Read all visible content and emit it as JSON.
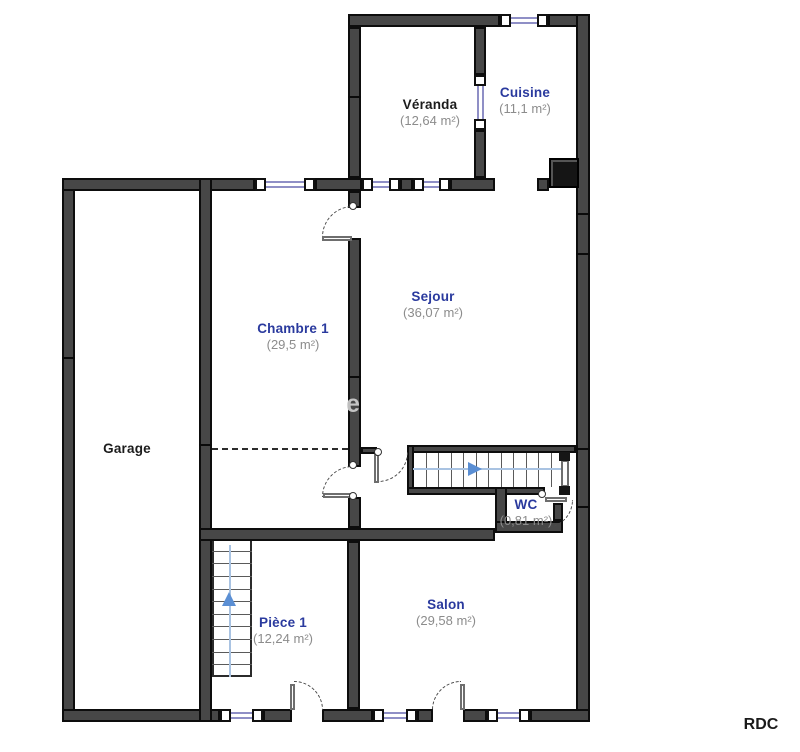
{
  "floor_label": "RDC",
  "watermark": "e",
  "colors": {
    "room_label_blue": "#2a3a9e",
    "room_label_black": "#1c1c1c",
    "area_label_gray": "#8c8c8c",
    "wall_fill": "#474747",
    "wall_edge": "#0d0d0d",
    "window_glass": "#8f8fc6",
    "stair_arrow_blue": "#5b8fd4"
  },
  "rooms": [
    {
      "id": "veranda",
      "name": "Véranda",
      "area": "(12,64 m²)",
      "label_style": "black",
      "cx": 430,
      "cy": 97,
      "area_cy": 113
    },
    {
      "id": "cuisine",
      "name": "Cuisine",
      "area": "(11,1 m²)",
      "label_style": "blue",
      "cx": 525,
      "cy": 85,
      "area_cy": 101
    },
    {
      "id": "chambre1",
      "name": "Chambre 1",
      "area": "(29,5 m²)",
      "label_style": "blue",
      "cx": 293,
      "cy": 321,
      "area_cy": 337
    },
    {
      "id": "sejour",
      "name": "Sejour",
      "area": "(36,07 m²)",
      "label_style": "blue",
      "cx": 433,
      "cy": 289,
      "area_cy": 305
    },
    {
      "id": "garage",
      "name": "Garage",
      "area": "",
      "label_style": "black",
      "cx": 127,
      "cy": 441,
      "area_cy": 0
    },
    {
      "id": "wc",
      "name": "WC",
      "area": "(0,81 m²)",
      "label_style": "blue",
      "cx": 526,
      "cy": 497,
      "area_cy": 513
    },
    {
      "id": "piece1",
      "name": "Pièce 1",
      "area": "(12,24 m²)",
      "label_style": "blue",
      "cx": 283,
      "cy": 615,
      "area_cy": 631
    },
    {
      "id": "salon",
      "name": "Salon",
      "area": "(29,58 m²)",
      "label_style": "blue",
      "cx": 446,
      "cy": 597,
      "area_cy": 613
    }
  ],
  "geometry": {
    "walls": [
      [
        348,
        14,
        152,
        13
      ],
      [
        548,
        14,
        42,
        13
      ],
      [
        576,
        14,
        14,
        708
      ],
      [
        62,
        178,
        13,
        544
      ],
      [
        62,
        709,
        158,
        13
      ],
      [
        263,
        709,
        29,
        13
      ],
      [
        322,
        709,
        51,
        13
      ],
      [
        417,
        709,
        16,
        13
      ],
      [
        463,
        709,
        24,
        13
      ],
      [
        530,
        709,
        60,
        13
      ],
      [
        62,
        178,
        193,
        13
      ],
      [
        315,
        178,
        47,
        13
      ],
      [
        400,
        178,
        13,
        13
      ],
      [
        450,
        178,
        45,
        13
      ],
      [
        537,
        178,
        12,
        13
      ],
      [
        348,
        27,
        13,
        151
      ],
      [
        474,
        27,
        12,
        48
      ],
      [
        474,
        130,
        12,
        48
      ],
      [
        199,
        178,
        13,
        544
      ],
      [
        348,
        191,
        13,
        17
      ],
      [
        348,
        238,
        13,
        229
      ],
      [
        348,
        497,
        13,
        31
      ],
      [
        199,
        528,
        296,
        13
      ],
      [
        347,
        541,
        13,
        168
      ],
      [
        407,
        445,
        169,
        8
      ],
      [
        407,
        445,
        7,
        50
      ],
      [
        407,
        487,
        138,
        8
      ],
      [
        495,
        487,
        12,
        46
      ],
      [
        495,
        521,
        68,
        12
      ],
      [
        553,
        503,
        10,
        18
      ],
      [
        361,
        447,
        16,
        7
      ]
    ],
    "joints": [
      [
        62,
        357,
        13,
        2
      ],
      [
        199,
        444,
        13,
        2
      ],
      [
        348,
        376,
        13,
        2
      ],
      [
        348,
        96,
        13,
        2
      ],
      [
        576,
        213,
        14,
        2
      ],
      [
        576,
        253,
        14,
        2
      ],
      [
        576,
        448,
        14,
        2
      ],
      [
        576,
        506,
        14,
        2
      ]
    ],
    "windows": [
      {
        "o": "h",
        "x": 500,
        "y": 14,
        "len": 48
      },
      {
        "o": "h",
        "x": 255,
        "y": 178,
        "len": 60
      },
      {
        "o": "h",
        "x": 362,
        "y": 178,
        "len": 38
      },
      {
        "o": "h",
        "x": 413,
        "y": 178,
        "len": 37
      },
      {
        "o": "v",
        "x": 474,
        "y": 75,
        "len": 55
      },
      {
        "o": "h",
        "x": 220,
        "y": 709,
        "len": 43
      },
      {
        "o": "h",
        "x": 373,
        "y": 709,
        "len": 44
      },
      {
        "o": "h",
        "x": 487,
        "y": 709,
        "len": 43
      }
    ],
    "door_arcs": [
      {
        "x": 322,
        "y": 206,
        "r": 31,
        "corner": "tl"
      },
      {
        "x": 322,
        "y": 466,
        "r": 31,
        "corner": "tl"
      },
      {
        "x": 378,
        "y": 452,
        "r": 30,
        "corner": "br"
      },
      {
        "x": 294,
        "y": 681,
        "r": 29,
        "corner": "tr"
      },
      {
        "x": 432,
        "y": 681,
        "r": 29,
        "corner": "tl"
      },
      {
        "x": 545,
        "y": 500,
        "r": 28,
        "corner": "br"
      }
    ],
    "door_leaves": [
      [
        322,
        236,
        30,
        5
      ],
      [
        323,
        493,
        30,
        5
      ],
      [
        374,
        454,
        5,
        29
      ],
      [
        290,
        684,
        5,
        26
      ],
      [
        460,
        684,
        5,
        26
      ],
      [
        545,
        497,
        22,
        5
      ],
      [
        561,
        460,
        8,
        27
      ]
    ],
    "blocks": [
      [
        559,
        452,
        11,
        9
      ],
      [
        559,
        486,
        11,
        9
      ]
    ],
    "hinges": [
      [
        349,
        202
      ],
      [
        374,
        448
      ],
      [
        349,
        461
      ],
      [
        349,
        492
      ],
      [
        538,
        490
      ]
    ],
    "stairs": [
      {
        "o": "h",
        "x": 413,
        "y": 453,
        "w": 150,
        "h": 34,
        "steps": 11,
        "boxed": false,
        "line": [
          413,
          468,
          150,
          2
        ],
        "arrow": {
          "dir": "right",
          "x": 468,
          "y": 462
        }
      },
      {
        "o": "v",
        "x": 212,
        "y": 538,
        "w": 40,
        "h": 139,
        "steps": 10,
        "boxed": true,
        "line": [
          229,
          545,
          2,
          132
        ],
        "arrow": {
          "dir": "up",
          "x": 222,
          "y": 592
        }
      }
    ],
    "dashlines": [
      [
        212,
        448,
        136
      ]
    ],
    "chimney": [
      549,
      158,
      30,
      30
    ]
  }
}
